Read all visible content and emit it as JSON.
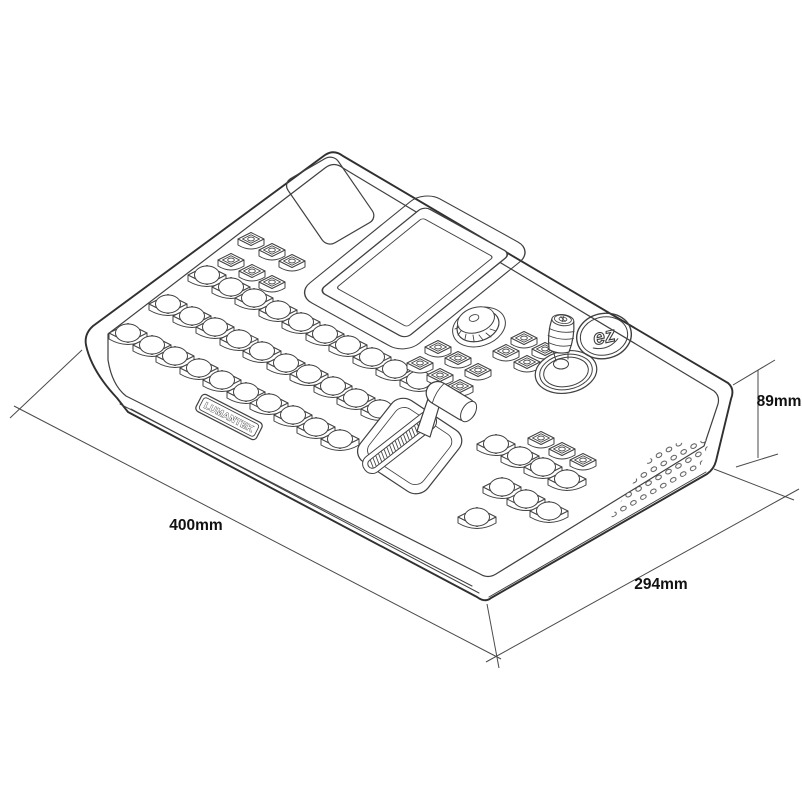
{
  "colors": {
    "background": "#ffffff",
    "line": "#404040",
    "line_strong": "#303030",
    "dimension_line": "#4a4a4a",
    "text": "#111111"
  },
  "drawing": {
    "brand_label": "LUMANTEK",
    "logo_text": "ez"
  },
  "dimension_annotations": {
    "width_label": "400mm",
    "depth_label": "294mm",
    "height_label": "89mm"
  }
}
